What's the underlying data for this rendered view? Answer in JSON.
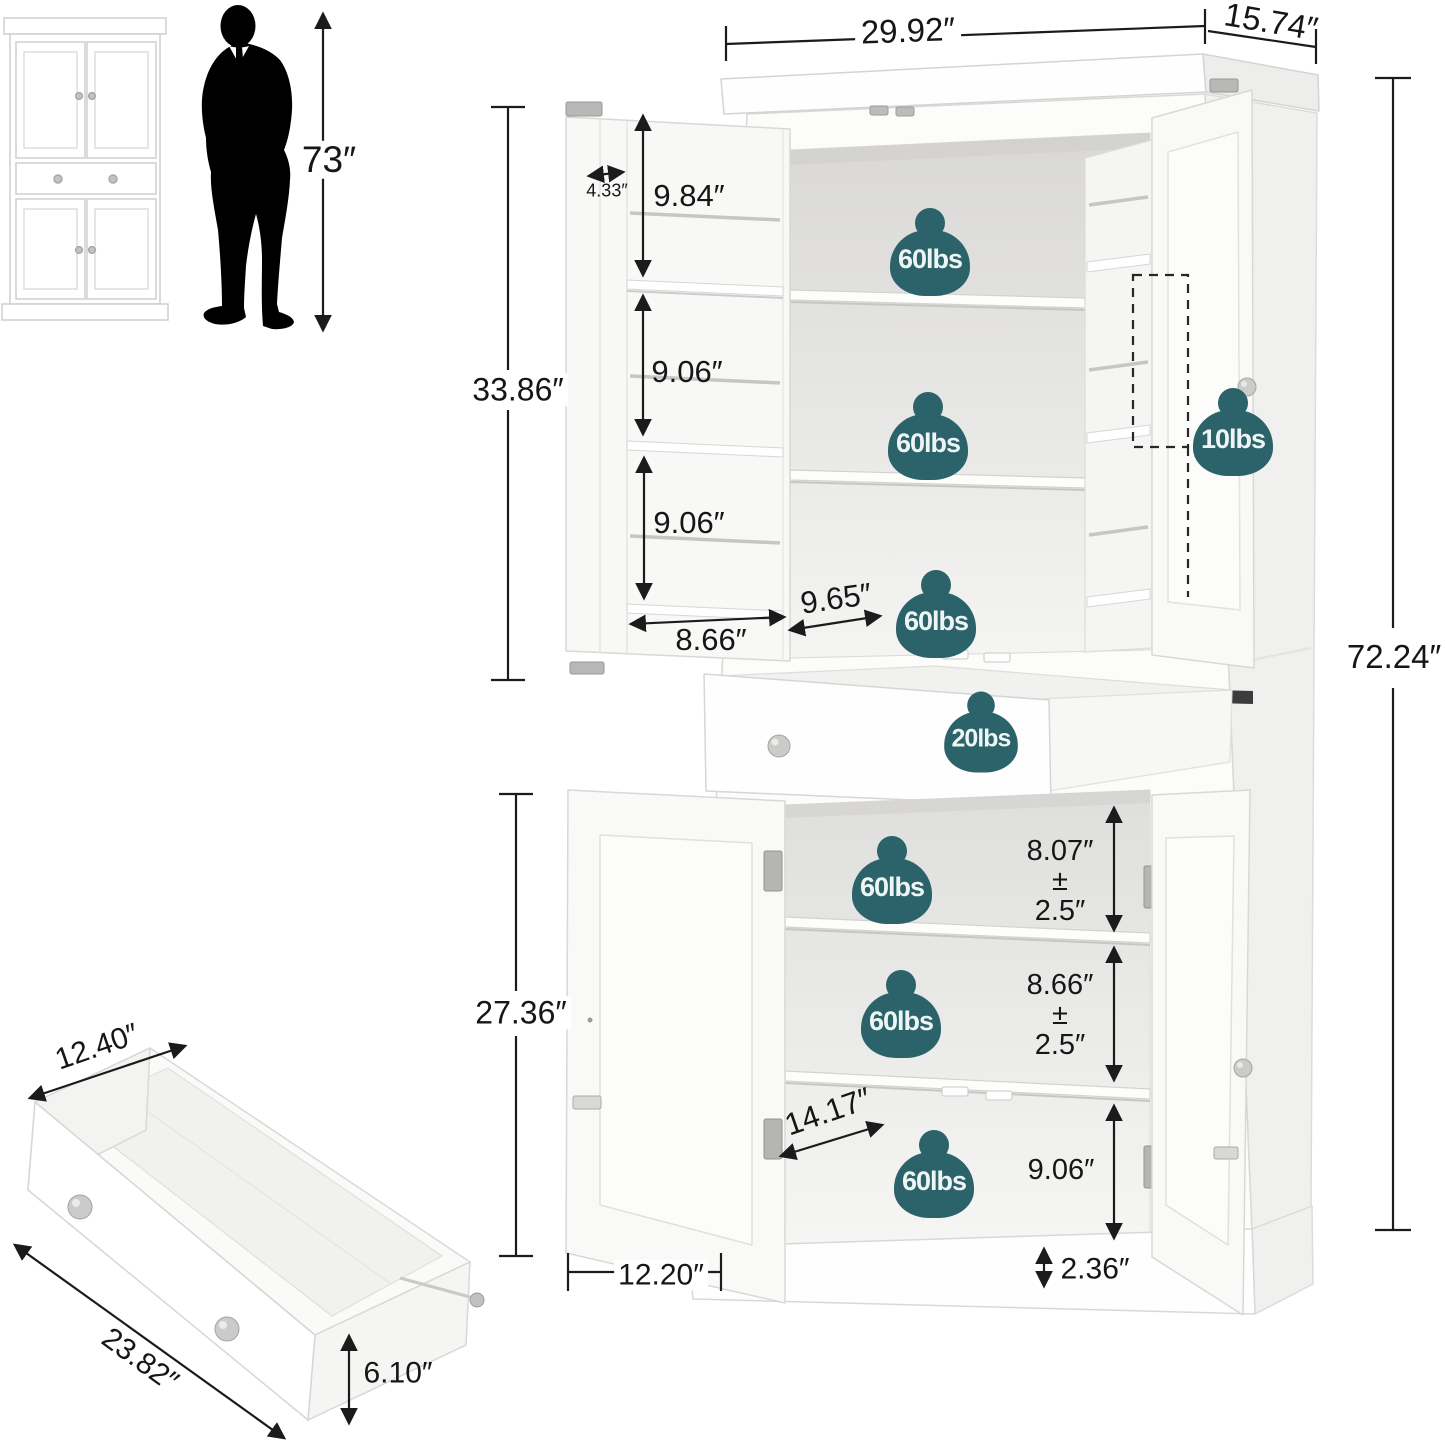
{
  "colors": {
    "badge_teal": "#2c626a",
    "ink": "#1a1a1a"
  },
  "person": {
    "height": "73″"
  },
  "overall": {
    "width": "29.92″",
    "depth": "15.74″",
    "height": "72.24″"
  },
  "upper": {
    "section_height": "33.86″",
    "door_rack_depth": "4.33″",
    "rack_opening_1": "9.84″",
    "rack_opening_2": "9.06″",
    "rack_opening_3": "9.06″",
    "door_rack_width": "8.66″",
    "shelf_depth": "9.65″",
    "shelf_capacity_1": "60lbs",
    "shelf_capacity_2": "60lbs",
    "shelf_capacity_3": "60lbs",
    "door_rack_capacity": "10lbs"
  },
  "drawer": {
    "capacity": "20lbs",
    "depth": "12.40″",
    "width": "23.82″",
    "height": "6.10″"
  },
  "lower": {
    "section_height": "27.36″",
    "gap_1": {
      "value": "8.07″",
      "pm": "±",
      "tol": "2.5″"
    },
    "gap_2": {
      "value": "8.66″",
      "pm": "±",
      "tol": "2.5″"
    },
    "gap_3": "9.06″",
    "interior_depth": "14.17″",
    "door_width": "12.20″",
    "base_height": "2.36″",
    "shelf_capacity_1": "60lbs",
    "shelf_capacity_2": "60lbs",
    "shelf_capacity_3": "60lbs"
  }
}
